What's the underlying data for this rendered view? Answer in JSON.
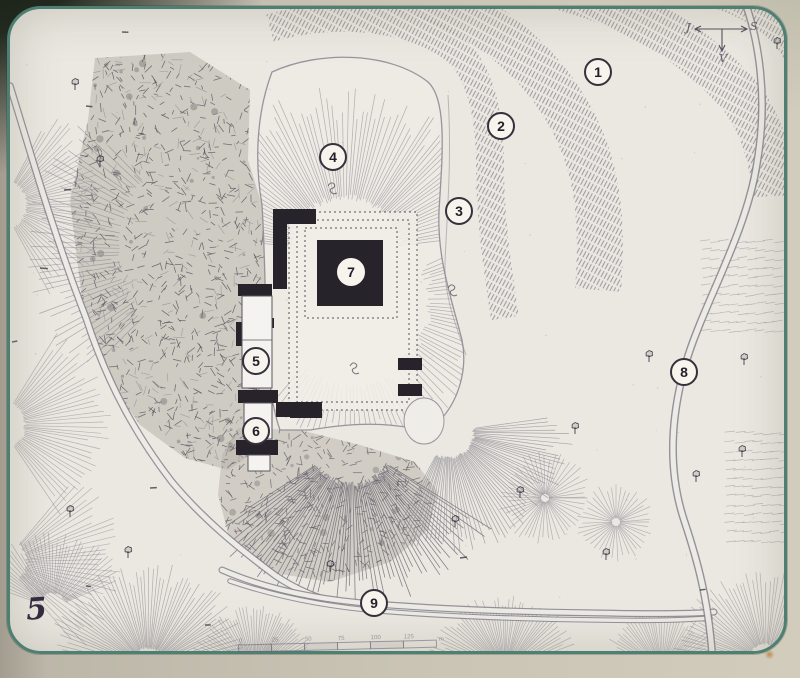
{
  "figure_label": "5",
  "compass": {
    "left": "J",
    "right": "S",
    "down": "V"
  },
  "markers": [
    {
      "id": "1",
      "x": 598,
      "y": 72,
      "variant": "default"
    },
    {
      "id": "2",
      "x": 501,
      "y": 126,
      "variant": "default"
    },
    {
      "id": "3",
      "x": 459,
      "y": 211,
      "variant": "default"
    },
    {
      "id": "4",
      "x": 333,
      "y": 157,
      "variant": "default"
    },
    {
      "id": "5",
      "x": 256,
      "y": 361,
      "variant": "default"
    },
    {
      "id": "6",
      "x": 256,
      "y": 431,
      "variant": "default"
    },
    {
      "id": "7",
      "x": 351,
      "y": 272,
      "variant": "on-dark"
    },
    {
      "id": "8",
      "x": 684,
      "y": 372,
      "variant": "default"
    },
    {
      "id": "9",
      "x": 374,
      "y": 603,
      "variant": "default"
    }
  ],
  "scale_bar": {
    "labels": [
      "0",
      "25",
      "50",
      "75",
      "100",
      "125"
    ],
    "unit": "m"
  },
  "colors": {
    "paper": "#eae8e1",
    "ink": "#2a2731",
    "hatch": "#8b8791",
    "teal_border": "#4e7f73",
    "marker_fill": "#f6f4ec",
    "marker_ring": "#34313d"
  }
}
